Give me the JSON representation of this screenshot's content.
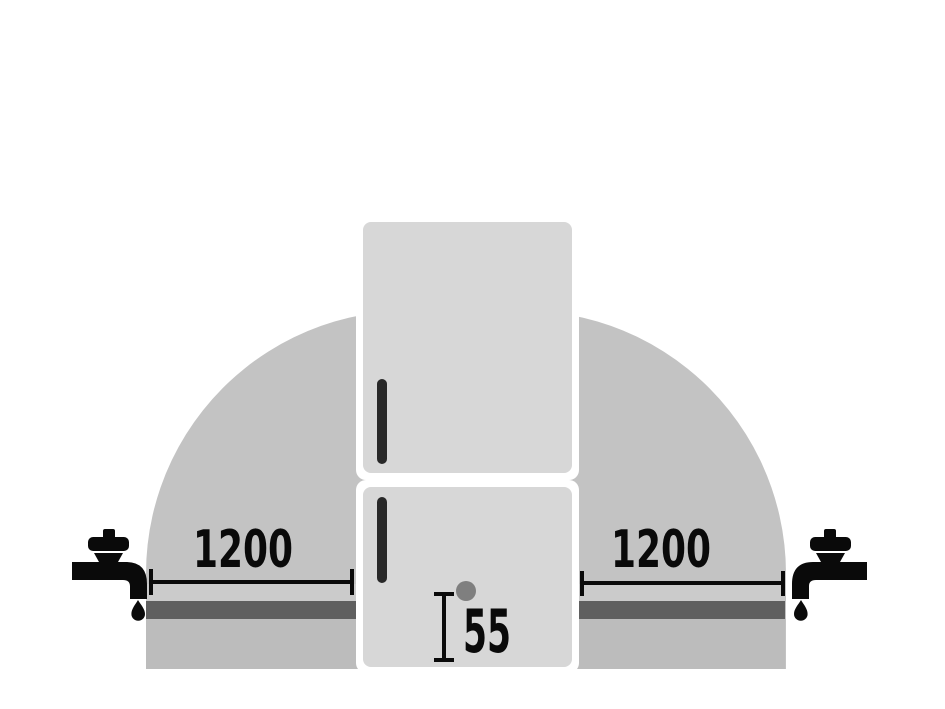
{
  "diagram": {
    "subject": "fridge-freezer water supply installation clearance diagram",
    "measurements": {
      "left": {
        "label": "1200"
      },
      "right": {
        "label": "1200"
      },
      "inlet_height": {
        "label": "55"
      }
    },
    "icons": [
      "faucet-left-icon",
      "faucet-right-icon",
      "water-drop-icon",
      "fridge-freezer",
      "door-handle",
      "water-inlet-dot",
      "dimension-line"
    ],
    "colors": {
      "background": "#ffffff",
      "dome": "#c3c3c3",
      "counter_strip": "#cbcbcb",
      "pipe_band": "#5f5f5f",
      "base_band": "#bcbcbc",
      "fridge": "#d7d7d7",
      "door_outline": "#ffffff",
      "handle": "#282828",
      "inlet_dot": "#7f7f7f",
      "ink": "#0a0a0a"
    }
  }
}
